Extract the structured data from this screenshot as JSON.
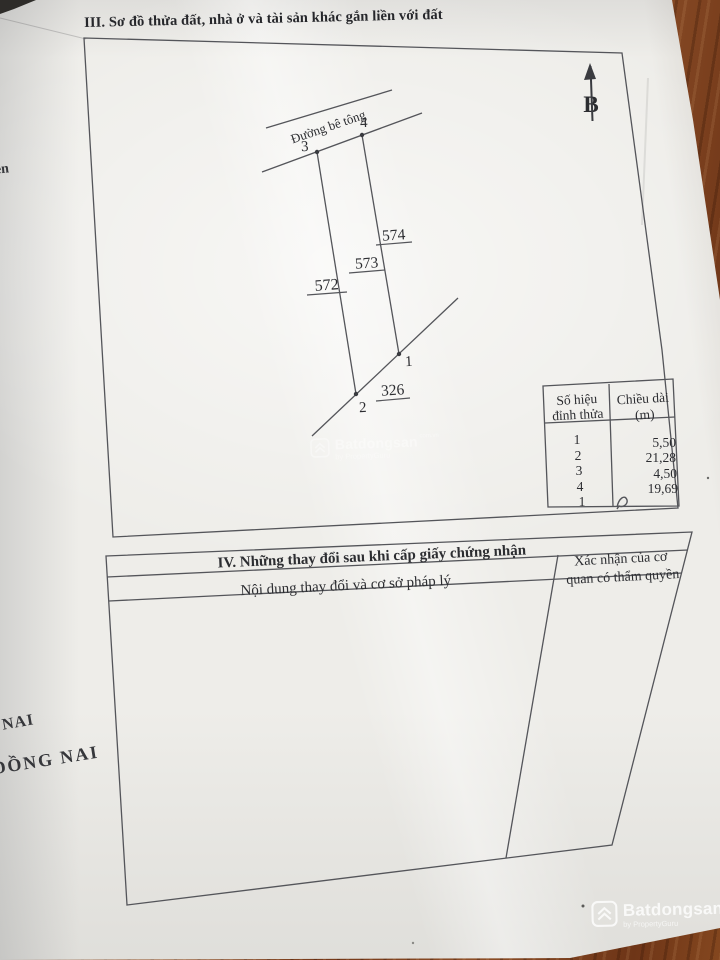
{
  "section3": {
    "title": "III. Sơ đồ thửa đất, nhà ở và tài sản khác gắn liền với đất"
  },
  "diagram": {
    "road_label": "Đường bê tông",
    "north_label": "B",
    "vertex_labels": {
      "v1": "1",
      "v2": "2",
      "v3": "3",
      "v4": "4"
    },
    "parcel_labels": {
      "left": "572",
      "center": "573",
      "right": "574",
      "bottom": "326"
    }
  },
  "parcel_table": {
    "header_col1_line1": "Số hiệu",
    "header_col1_line2": "đỉnh thửa",
    "header_col2_line1": "Chiều dài",
    "header_col2_line2": "(m)",
    "rows": [
      {
        "vertex": "1",
        "length": "5,50"
      },
      {
        "vertex": "2",
        "length": "21,28"
      },
      {
        "vertex": "3",
        "length": "4,50"
      },
      {
        "vertex": "4",
        "length": "19,69"
      },
      {
        "vertex": "1",
        "length": ""
      }
    ]
  },
  "section4": {
    "title": "IV. Những thay đổi sau khi cấp giấy chứng nhận",
    "col1_header": "Nội dung thay đổi và cơ sở pháp lý",
    "col2_header_line1": "Xác nhận của cơ",
    "col2_header_line2": "quan có thẩm quyền"
  },
  "edge_fragments": {
    "f1": "ên",
    "f2": "NAI",
    "f3": "ĐỒNG NAI"
  },
  "watermark": {
    "brand": "Batdongsan",
    "domain": "com.vn",
    "byline": "by PropertyGuru"
  },
  "colors": {
    "paper": "#eeede9",
    "ink": "#2c2d31",
    "line": "#54555a",
    "wood": "#84471f"
  }
}
